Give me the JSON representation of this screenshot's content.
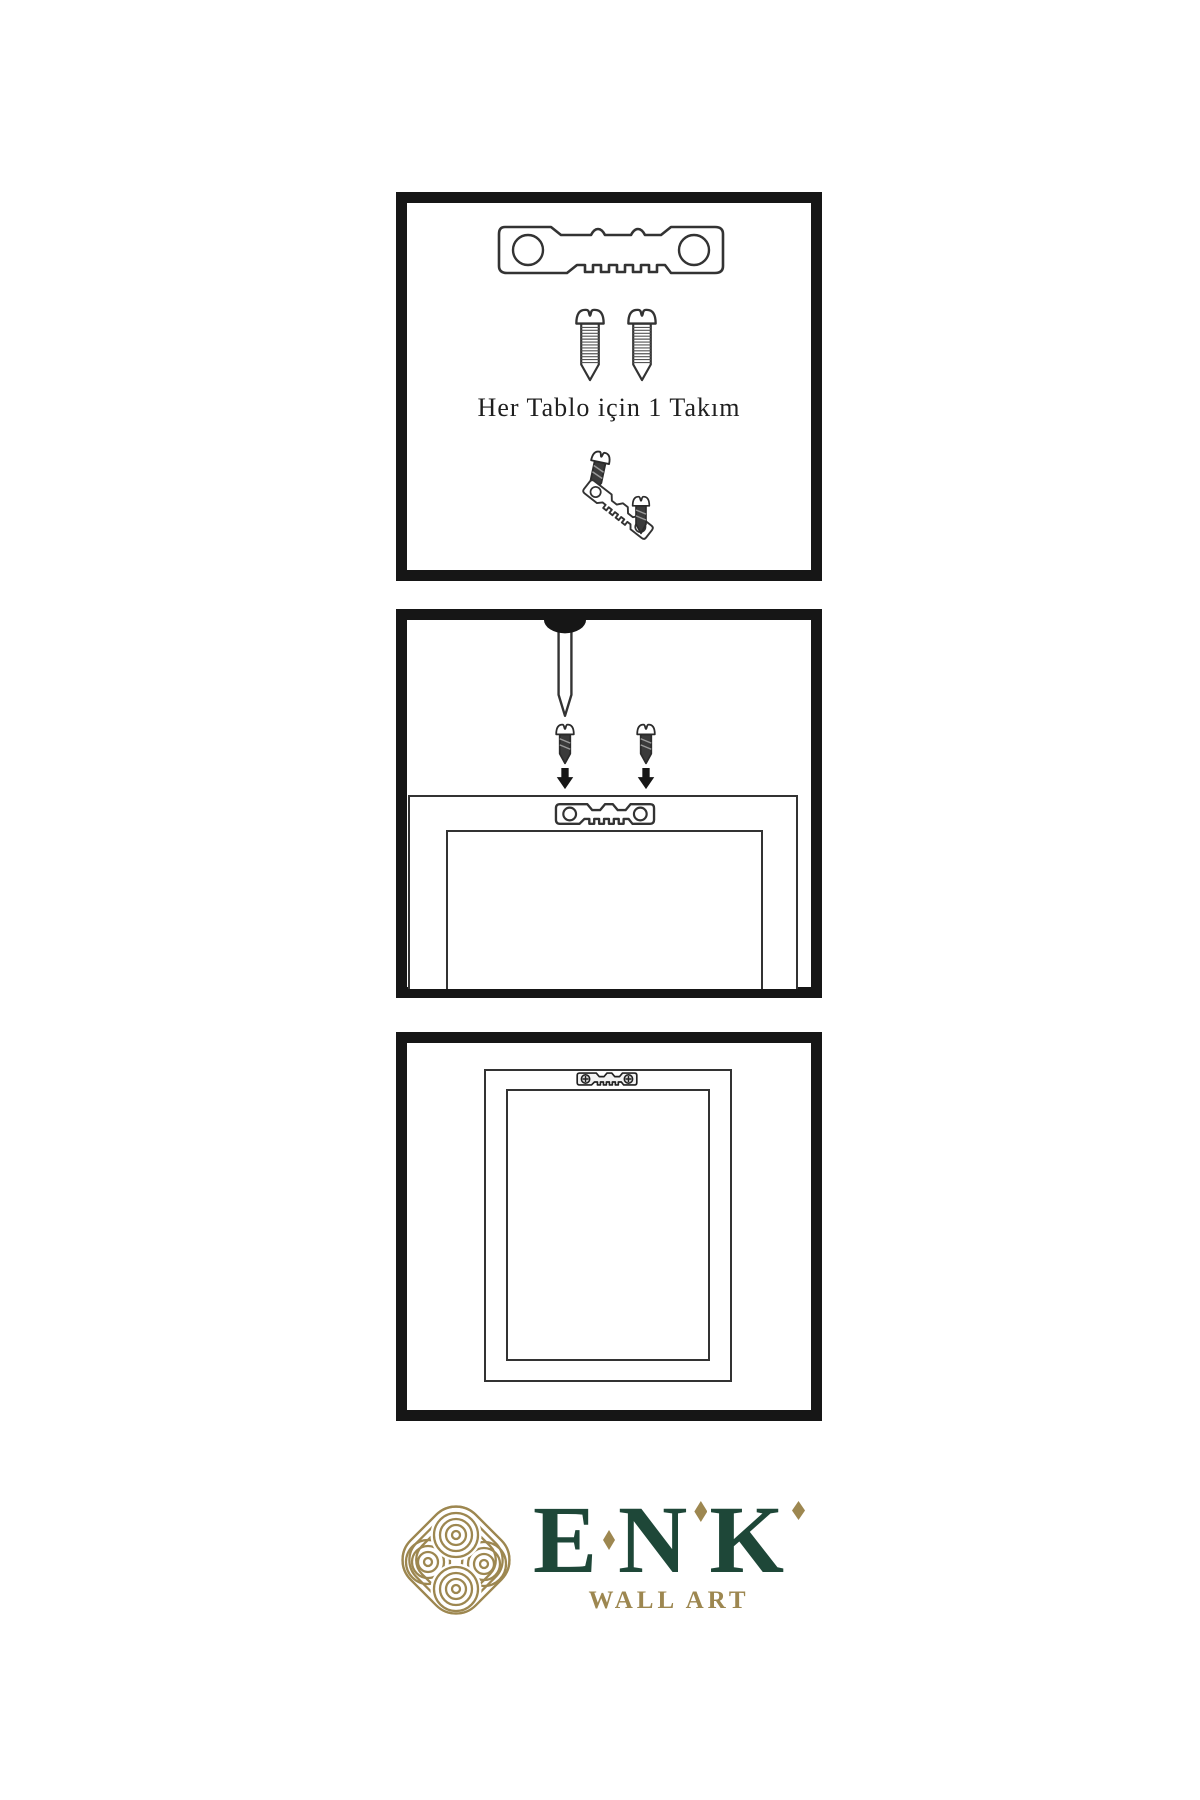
{
  "colors": {
    "background": "#ffffff",
    "panel_border": "#161616",
    "line_art": "#333333",
    "caption_text": "#1f1f1f",
    "brand_green": "#1e4738",
    "brand_gold": "#9d8750"
  },
  "panel_hardware_kit": {
    "caption": "Her Tablo için 1 Takım"
  },
  "brand": {
    "letters": [
      "E",
      "N",
      "K"
    ],
    "tagline": "WALL ART"
  }
}
